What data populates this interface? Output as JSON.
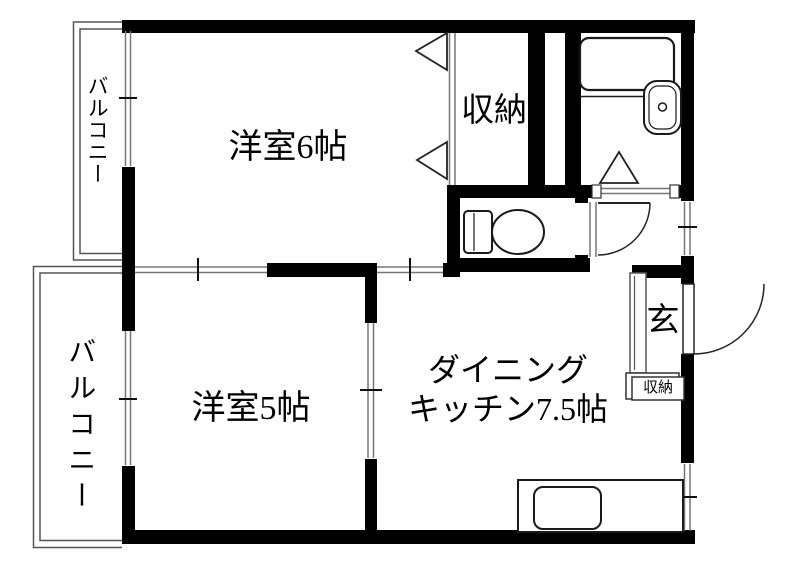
{
  "floorplan": {
    "labels": {
      "room6": "洋室6帖",
      "room5": "洋室5帖",
      "dk_line1": "ダイニング",
      "dk_line2": "キッチン7.5帖",
      "closet": "収納",
      "entrance": "玄",
      "entrance_storage": "収納",
      "balcony_top": "バルコニー",
      "balcony_bottom": "バルコニー"
    },
    "colors": {
      "wall": "#000000",
      "background": "#ffffff",
      "fixture_line": "#1a1a1a",
      "window_line": "#777777",
      "balcony_line": "#555555"
    }
  }
}
